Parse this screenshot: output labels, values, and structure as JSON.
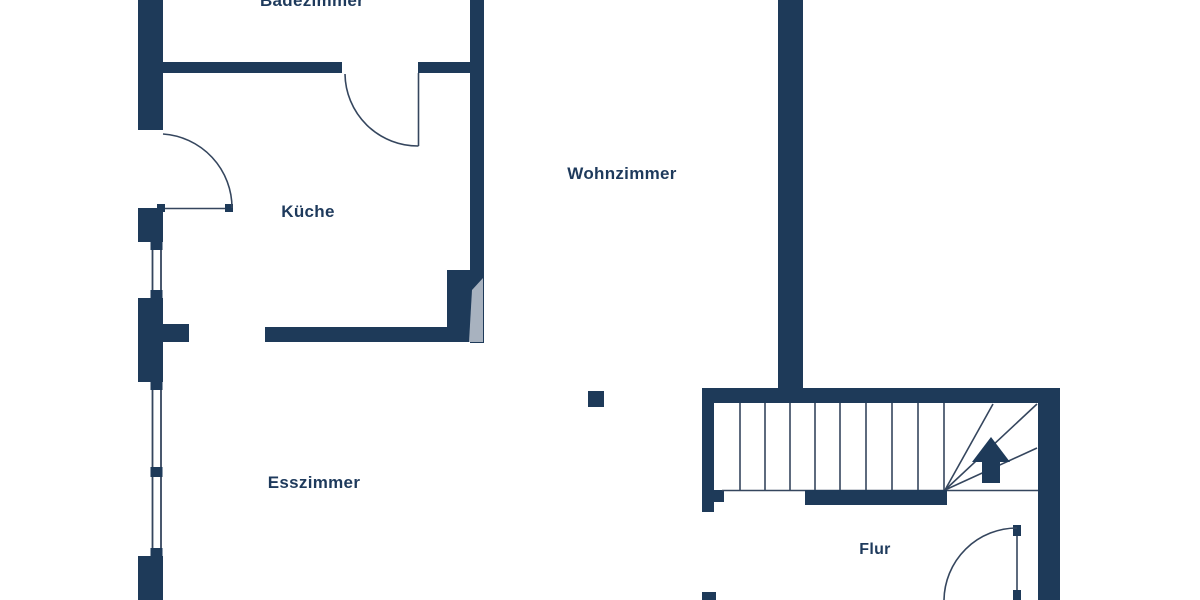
{
  "plan": {
    "rooms": [
      {
        "id": "badezimmer",
        "label": "Badezimmer"
      },
      {
        "id": "kueche",
        "label": "Küche"
      },
      {
        "id": "wohnzimmer",
        "label": "Wohnzimmer"
      },
      {
        "id": "esszimmer",
        "label": "Esszimmer"
      },
      {
        "id": "flur",
        "label": "Flur"
      }
    ],
    "stairs": {
      "direction": "up",
      "straight_treads": 8,
      "winder_treads": 3
    },
    "windows_on_left_wall": 2,
    "doors": 3,
    "colors": {
      "wall": "#1e3a59",
      "line": "#35465e",
      "fixture": "#a8b2bf",
      "background": "#ffffff",
      "label": "#1e3a5c"
    }
  }
}
